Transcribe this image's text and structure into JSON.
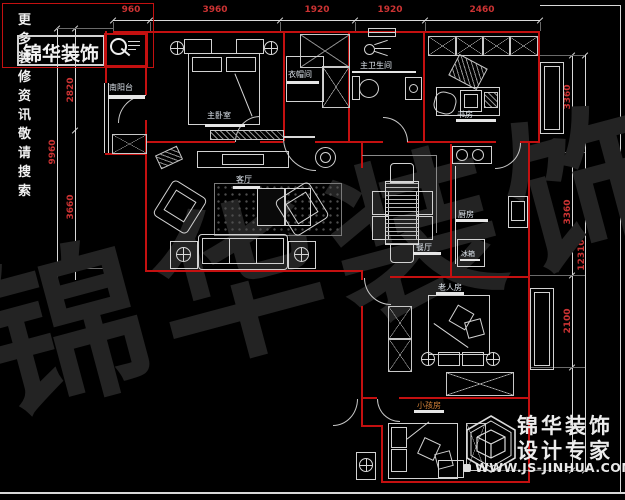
{
  "header": {
    "search_hint": "更多装修资讯敬请搜索",
    "brand": "锦华装饰"
  },
  "watermark": "锦华装饰",
  "dims": {
    "top": [
      "960",
      "3960",
      "1920",
      "1920",
      "2460"
    ],
    "left_outer": "9960",
    "left_inner": [
      "2820",
      "3660"
    ],
    "right_inner": [
      "3360",
      "3360",
      "2100"
    ],
    "right_outer": "12310"
  },
  "rooms": {
    "balcony": "南阳台",
    "master_bedroom": "主卧室",
    "cloakroom": "衣帽间",
    "master_bath": "主卫生间",
    "study": "书房",
    "living": "客厅",
    "dining": "餐厅",
    "kitchen": "厨房",
    "fridge": "冰箱",
    "elder": "老人房",
    "kids": "小孩房"
  },
  "footer": {
    "brand": "锦华装饰",
    "tagline": "设计专家",
    "url": "WWW.JS-JINHUA.COM"
  },
  "colors": {
    "wall": "#c41010",
    "dim_text": "#cc3333",
    "line": "#d8d8d8",
    "background": "#000000"
  }
}
